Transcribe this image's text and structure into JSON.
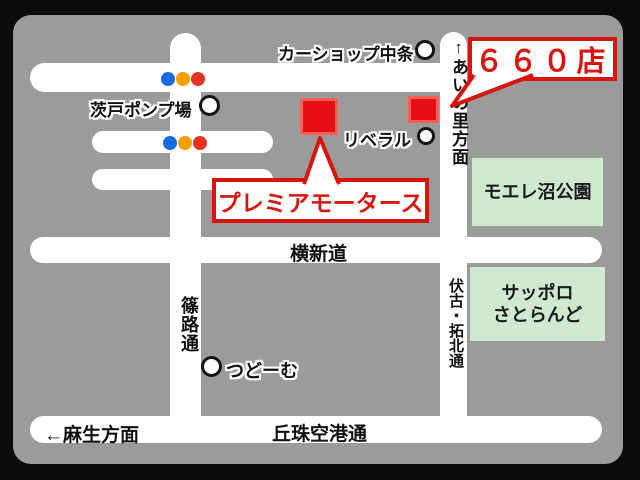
{
  "map": {
    "store_badge": {
      "label": "６６０店"
    },
    "store_box": {
      "label": "プレミアモータース"
    },
    "landmarks": {
      "car_shop_nakajo": "カーショップ中条",
      "barato_pump": "茨戸ポンプ場",
      "liberal": "リベラル",
      "tsudome": "つどーむ",
      "moere_park": "モエレ沼公園",
      "satoland_line1": "サッポロ",
      "satoland_line2": "さとらんど"
    },
    "roads": {
      "yokoshindo": "横新道",
      "okadama_airport": "丘珠空港通",
      "asabu_direction": "←麻生方面",
      "shinoro": "篠路通",
      "fushiko_takuhoku": "伏古・拓北通",
      "ainosato_direction": "↑あいの里方面"
    },
    "colors": {
      "background": "#0c0c0c",
      "map_bg": "#9b9b9b",
      "road": "#ffffff",
      "accent_red": "#d6150f",
      "square_red": "#e60f15",
      "green_box": "#cfe9d1",
      "signal_blue": "#1a6be0",
      "signal_yellow": "#f6a000",
      "signal_red": "#e53323"
    }
  }
}
